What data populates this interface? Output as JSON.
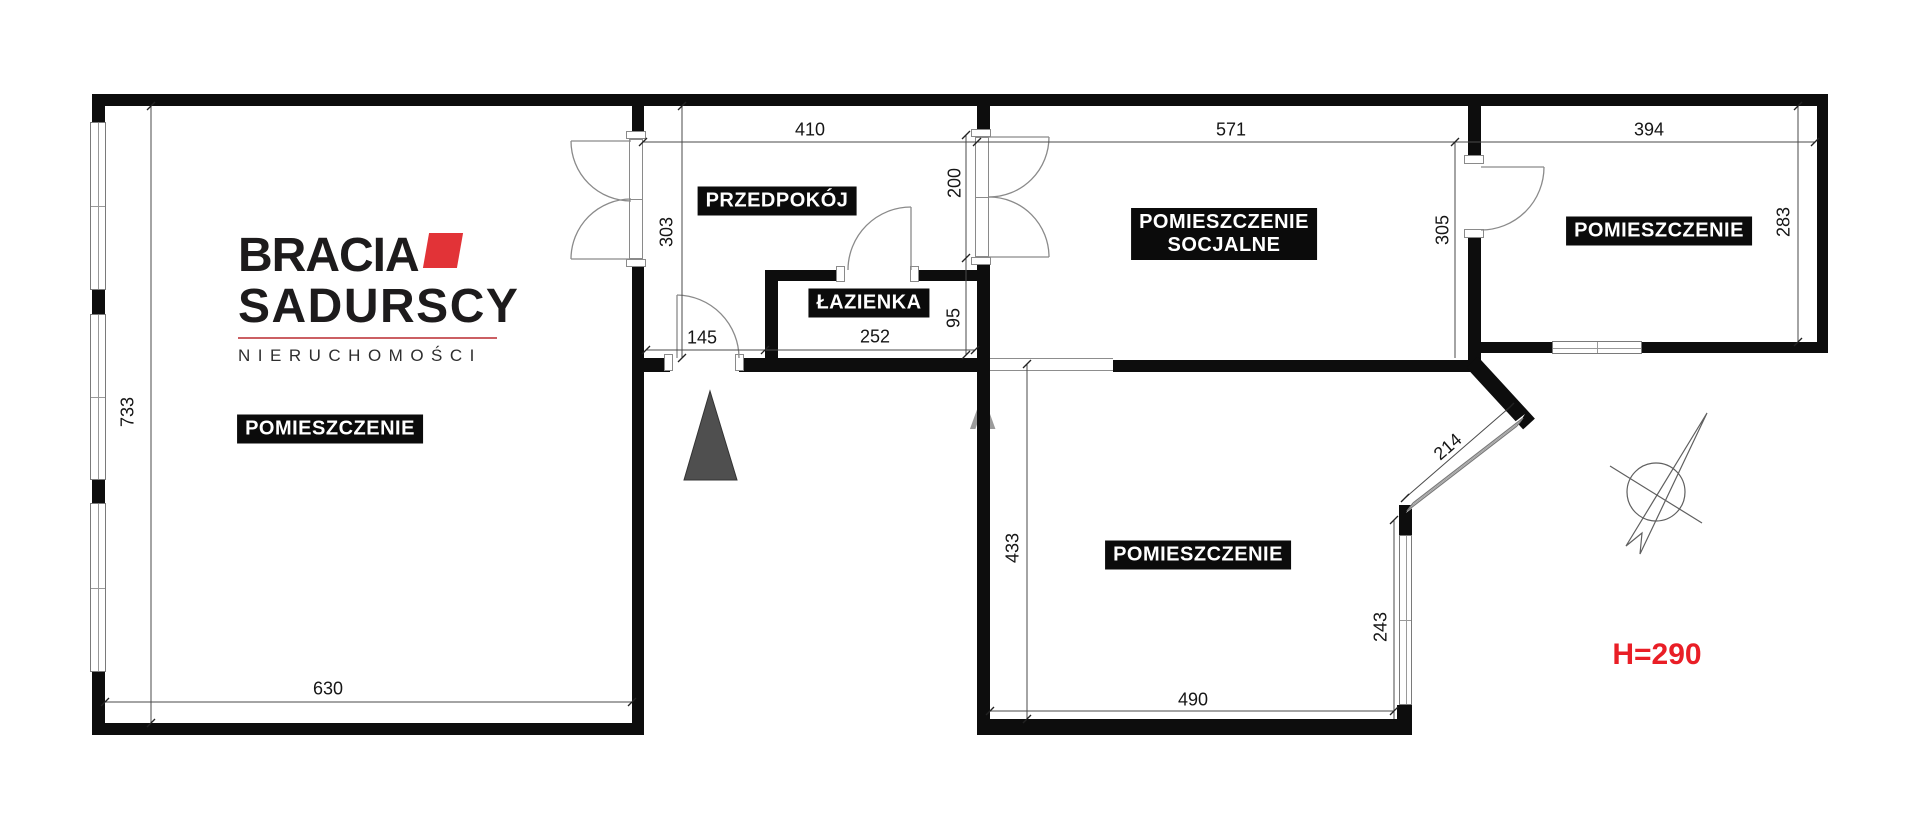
{
  "branding": {
    "line1": "BRACIA",
    "line2": "SADURSCY",
    "line3": "NIERUCHOMOŚCI"
  },
  "rooms": {
    "left": "POMIESZCZENIE",
    "hall": "PRZEDPOKÓJ",
    "bath": "ŁAZIENKA",
    "social_line1": "POMIESZCZENIE",
    "social_line2": "SOCJALNE",
    "right": "POMIESZCZENIE",
    "bottom": "POMIESZCZENIE"
  },
  "dims": {
    "hall_width": "410",
    "hall_depth": "303",
    "social_door": "200",
    "social_width": "571",
    "social_depth": "305",
    "right_width": "394",
    "right_depth": "283",
    "left_depth": "733",
    "left_width": "630",
    "entry_door": "145",
    "bath_width": "252",
    "bath_depth": "95",
    "bottom_depth": "433",
    "bottom_width": "490",
    "bottom_window": "243",
    "diag_window": "214"
  },
  "notes": {
    "ceiling_height": "H=290"
  },
  "watermark": {
    "letter": "A"
  },
  "colors": {
    "wall": "#0d0d0d",
    "accent_red": "#e23337",
    "note_red": "#e91e26"
  }
}
